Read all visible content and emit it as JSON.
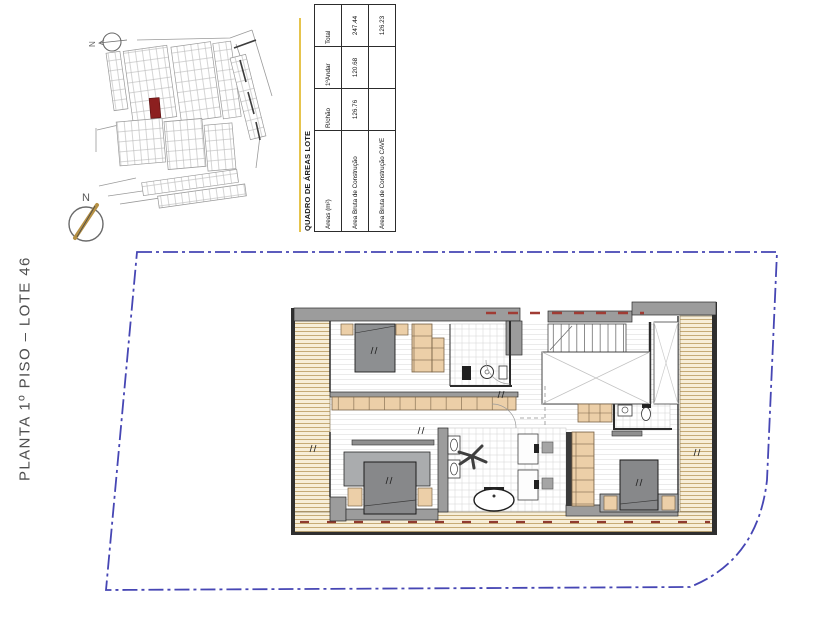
{
  "sheet": {
    "title": "PLANTA 1º PISO – LOTE 46"
  },
  "north_arrow": {
    "label": "N"
  },
  "site_map": {
    "north_label": "N",
    "highlight_color": "#8c1f1f"
  },
  "areas_table": {
    "title": "QUADRO DE ÁREAS LOTE",
    "columns": [
      "Areas (m²)",
      "R/chão",
      "1ºAndar",
      "Total"
    ],
    "rows": [
      {
        "label": "Area Bruta de Construção",
        "values": [
          "126.76",
          "120.68",
          "247.44"
        ]
      },
      {
        "label": "Area Bruta de Construção CAVE",
        "values": [
          "",
          "",
          "126.23"
        ]
      }
    ]
  },
  "boundary": {
    "color": "#4646b4",
    "style": "dash-dot"
  },
  "plan_colors": {
    "wall_gray": "#9c9c9c",
    "wood_tan": "#eccfa8",
    "deck_bg": "#f7eed8",
    "accent_red": "#8f3b30",
    "bed_gray": "#87888a"
  }
}
